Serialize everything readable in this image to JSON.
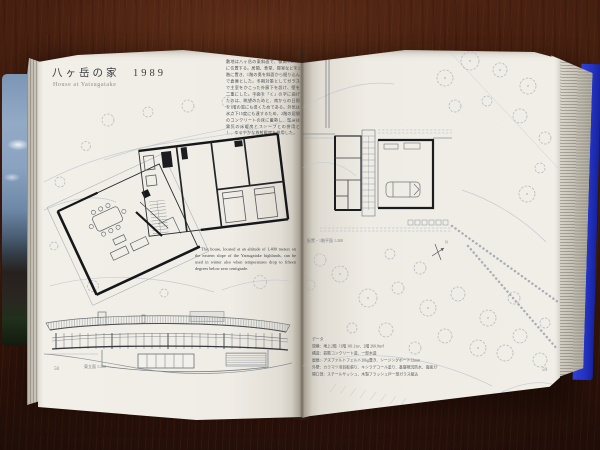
{
  "palette": {
    "wood": "#38180c",
    "page": "#f0ede6",
    "cover_back_blue": "#2433c4",
    "cover_front_sky": "#8aa3c0",
    "ink_dark": "#1a1c1f",
    "ink_light": "#b3bac2"
  },
  "book": {
    "left_page": {
      "title_jp": "八ヶ岳の家　1989",
      "title_en": "House at Yatsugatake",
      "body_text_jp": "敷地は八ヶ岳の東斜面で、標高1,400mに位置する。居間、食堂、寝室などを2階に置き、1階の奥を斜面から掘り込んで倉庫とした。冬期対策としてガラスで主室をかこった外廊下を設け、壁を二重にした。平面を「く」の字に曲げたのは、眺望のためと、南からの日照を1階の窓にも導くためである。外気は氷点下15度にも達するため、2階の居間のコンクリートの床に蓄熱し、暖房は電気の床暖房とストーブとの併用とし、ゆるやかな放射暖房を併用した。",
      "caption_en": "This house, located at an altitude of 1,400 meters on the eastern slope of the Yatsugatake highlands, can be used in winter also when temperatures drop to fifteen degrees below zero centigrade.",
      "elevation_label": "東立面 1:200",
      "page_number": "58"
    },
    "right_page": {
      "plan_label": "配置・1階平面 1:200",
      "north_label": "N",
      "data_block": [
        "データ",
        "規模：地上2階（1階 101.1m²、2階 260.9m²）",
        "構造：鉄筋コンクリート造、一部木造",
        "屋根：アスファルトフェルト20kg葺き、シージングボード12mm",
        "外壁：カラマツ羽目板張り、キシラデコール塗り、基礎現況防水、南面ガラス",
        "開口部：スチールサッシュ、木製フラッシュ戸一部ガラス組込"
      ],
      "page_number": "59"
    }
  }
}
